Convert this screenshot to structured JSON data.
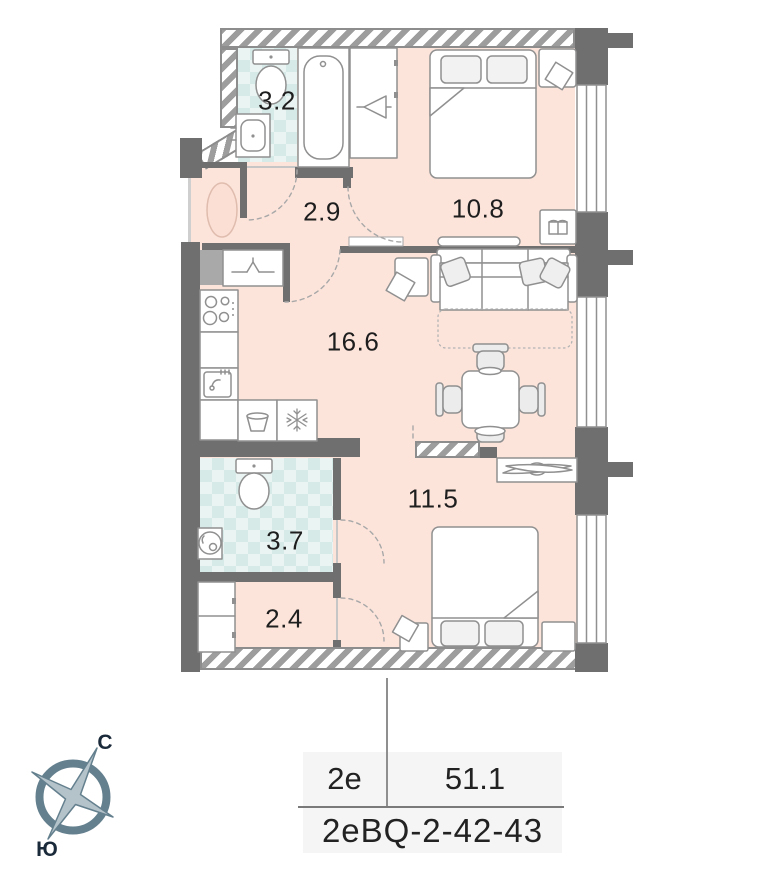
{
  "plan": {
    "title": "apartment-floor-plan",
    "rooms": [
      {
        "name": "bathroom-top",
        "area": "3.2"
      },
      {
        "name": "hallway-top",
        "area": "2.9"
      },
      {
        "name": "bedroom-top",
        "area": "10.8"
      },
      {
        "name": "kitchen-living-room",
        "area": "16.6"
      },
      {
        "name": "bathroom-bottom",
        "area": "3.7"
      },
      {
        "name": "hallway-bottom",
        "area": "2.4"
      },
      {
        "name": "bedroom-bottom",
        "area": "11.5"
      }
    ],
    "icons": [
      "toilet-icon",
      "bath-sink-icon",
      "bathtub-icon",
      "hanger-icon",
      "double-bed-icon",
      "pillow-icon",
      "nightstand-icon",
      "open-book-icon",
      "tv-console-icon",
      "sofa-icon",
      "dining-table-icon",
      "chair-icon",
      "stove-icon",
      "kitchen-sink-icon",
      "washing-machine-icon",
      "fridge-snowflake-icon",
      "round-sink-icon",
      "wardrobe-icon",
      "shelf-decor-icon",
      "window-icon",
      "door-swing-arc",
      "entry-rug-icon",
      "compass-rose-icon"
    ]
  },
  "info_table": {
    "layout_code": "2e",
    "total_area": "51.1",
    "unit_code": "2eBQ-2-42-43"
  },
  "compass": {
    "north_label": "С",
    "south_label": "Ю"
  },
  "colors": {
    "floor_pink": "#fce4db",
    "tile_teal": "#d6eae8",
    "wall_gray": "#6f6f6f",
    "compass_blue": "#64808e",
    "label_dark": "#1e1e1e"
  }
}
